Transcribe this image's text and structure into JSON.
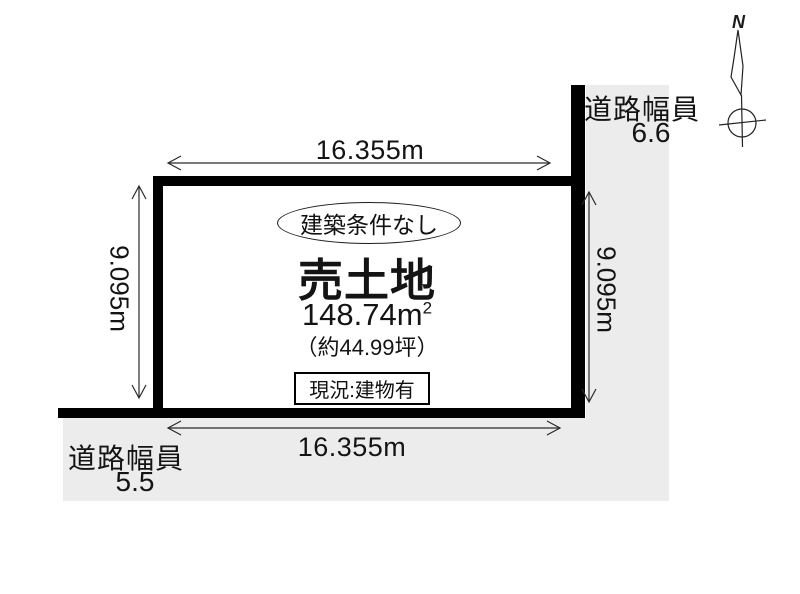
{
  "compass": {
    "north_label": "N"
  },
  "roads": {
    "right": {
      "label": "道路幅員",
      "value": "6.6"
    },
    "bottom": {
      "label": "道路幅員",
      "value": "5.5"
    }
  },
  "dimensions": {
    "top_width": "16.355m",
    "bottom_width": "16.355m",
    "left_depth": "9.095m",
    "right_depth": "9.095m"
  },
  "parcel": {
    "badge": "建築条件なし",
    "title": "売土地",
    "area_m2_base": "148.74m",
    "area_m2_sup": "2",
    "area_tsubo": "（約44.99坪）",
    "status": "現況:建物有"
  },
  "colors": {
    "road_fill": "#ececec",
    "outline": "#000000"
  }
}
